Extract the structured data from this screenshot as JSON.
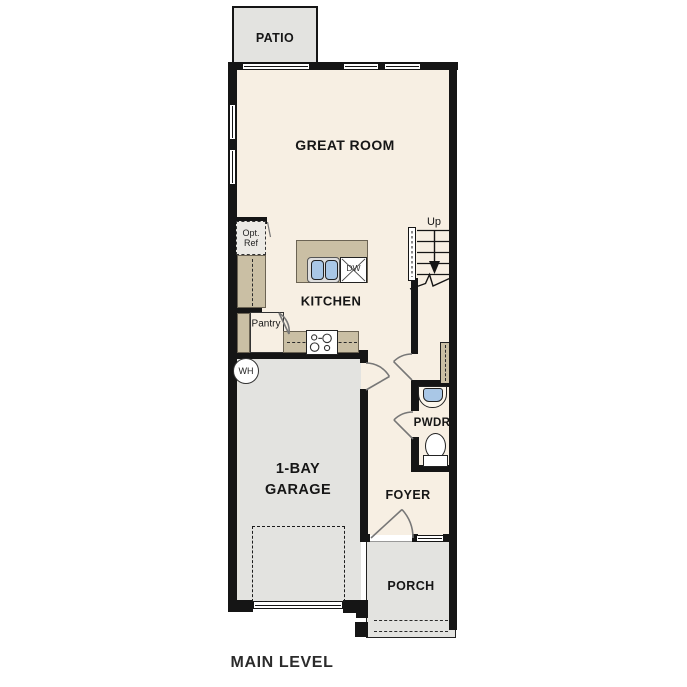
{
  "title": "MAIN LEVEL",
  "colors": {
    "wall": "#151515",
    "floor": "#f7efe3",
    "concrete": "#e3e3e0",
    "counter": "#cabfa4",
    "sink": "#a9c7e6",
    "door_swing": "#777777"
  },
  "rooms": {
    "patio": {
      "label": "PATIO"
    },
    "great_room": {
      "label": "GREAT ROOM"
    },
    "kitchen": {
      "label": "KITCHEN"
    },
    "pantry": {
      "label": "Pantry"
    },
    "garage": {
      "line1": "1-BAY",
      "line2": "GARAGE"
    },
    "powder": {
      "label": "PWDR"
    },
    "foyer": {
      "label": "FOYER"
    },
    "porch": {
      "label": "PORCH"
    }
  },
  "fixtures": {
    "opt_ref_line1": "Opt.",
    "opt_ref_line2": "Ref",
    "dishwasher": "DW",
    "water_heater": "WH",
    "stairs_up": "Up"
  }
}
